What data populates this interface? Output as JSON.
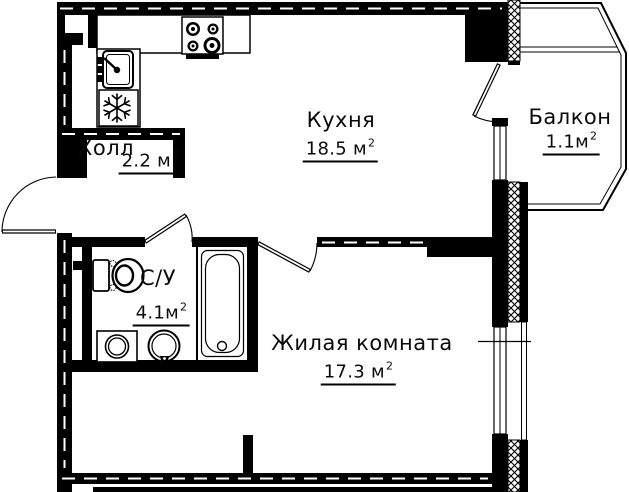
{
  "plan": {
    "type": "apartment-floor-plan",
    "colors": {
      "line": "#000000",
      "background": "#ffffff"
    },
    "rooms": [
      {
        "id": "kitchen",
        "label": "Кухня",
        "area": "18.5 м",
        "area_sup": "2"
      },
      {
        "id": "balcony",
        "label": "Балкон",
        "area": "1.1м",
        "area_sup": "2"
      },
      {
        "id": "hall",
        "label": "Холл",
        "area": "2.2 м",
        "area_sup": "2"
      },
      {
        "id": "bathroom",
        "label": "С/У",
        "area": "4.1м",
        "area_sup": "2"
      },
      {
        "id": "living_room",
        "label": "Жилая комната",
        "area": "17.3 м",
        "area_sup": "2"
      }
    ],
    "fixtures": [
      "stove-icon",
      "kitchen-sink-icon",
      "fridge-snowflake-icon",
      "toilet-icon",
      "bathtub-icon",
      "washing-machine-icon",
      "bathroom-sink-icon"
    ],
    "doors": [
      "entrance-door",
      "bathroom-door",
      "living-room-door",
      "balcony-door"
    ],
    "windows": [
      "kitchen-window",
      "living-room-window"
    ]
  }
}
